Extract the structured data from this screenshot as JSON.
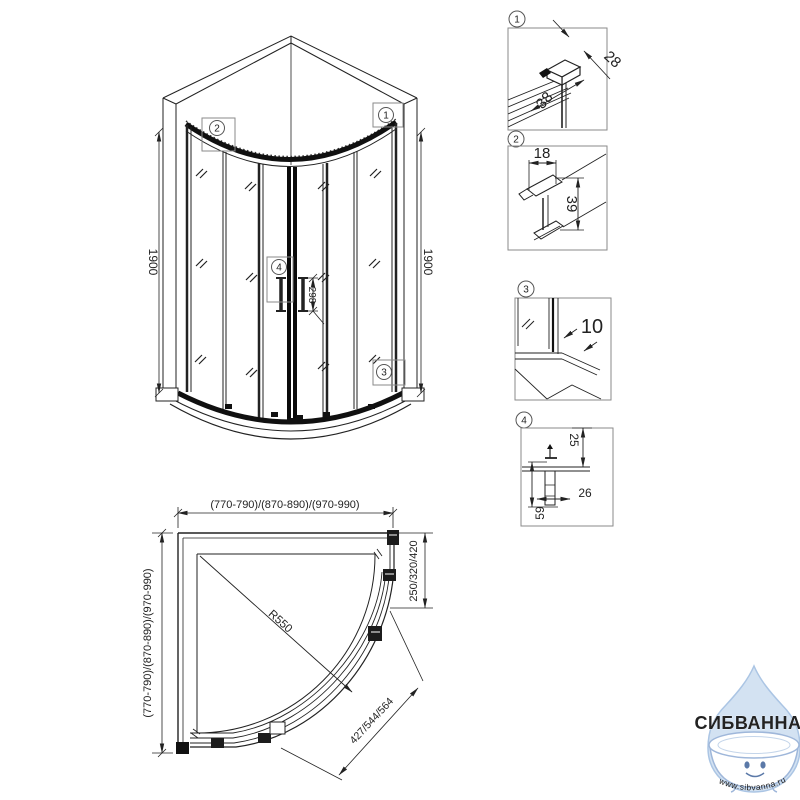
{
  "front_view": {
    "height_left": "1900",
    "height_right": "1900",
    "handle_height": "298",
    "callout_1": "1",
    "callout_2": "2",
    "callout_3": "3",
    "callout_4": "4"
  },
  "plan_view": {
    "width_top": "(770-790)/(870-890)/(970-990)",
    "depth_left": "(770-790)/(870-890)/(970-990)",
    "door_opening": "250/320/420",
    "entry_width": "427/544/564",
    "radius": "R550"
  },
  "details": {
    "d1": {
      "num": "1",
      "dim_a": "28",
      "dim_b": "38"
    },
    "d2": {
      "num": "2",
      "dim_a": "18",
      "dim_b": "39"
    },
    "d3": {
      "num": "3",
      "dim_a": "10"
    },
    "d4": {
      "num": "4",
      "dim_a": "25",
      "dim_b": "26",
      "dim_c": "59"
    }
  },
  "watermark": {
    "brand": "СИБВАННА",
    "url": "www.sibvanna.ru"
  },
  "colors": {
    "line": "#222222",
    "heavy": "#101010",
    "box": "#8a8a8a",
    "brand": "#a6b8dc",
    "drop_fill": "#d3e2f2",
    "drop_stroke": "#abc5e4",
    "url_text": "#8fadd4"
  }
}
